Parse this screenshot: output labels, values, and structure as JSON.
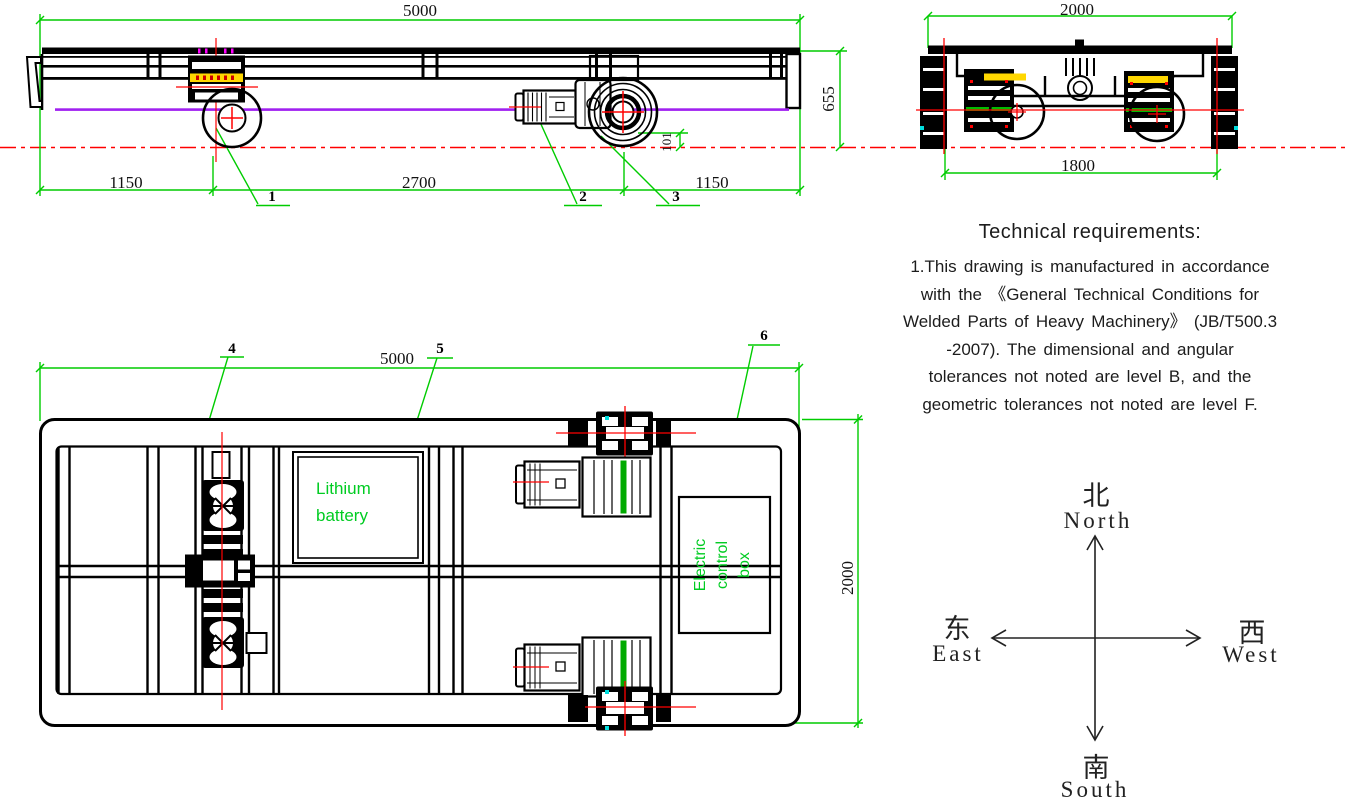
{
  "side_view": {
    "dim_overall_length": "5000",
    "dim_left_overhang": "1150",
    "dim_wheelbase": "2700",
    "dim_right_overhang": "1150",
    "dim_height": "655",
    "dim_flange_height": "101",
    "callouts": [
      "1",
      "2",
      "3"
    ]
  },
  "end_view": {
    "dim_overall_width": "2000",
    "dim_rail_gauge": "1800"
  },
  "plan_view": {
    "dim_length": "5000",
    "dim_width": "2000",
    "callouts": [
      "4",
      "5",
      "6"
    ],
    "battery_label_lines": [
      "Lithium",
      "battery"
    ],
    "control_box_label_lines": [
      "Electric",
      "control",
      "box"
    ]
  },
  "technical_requirements": {
    "title": "Technical requirements:",
    "lines": [
      "1.This drawing is manufactured in accordance",
      "with the 《General Technical Conditions for",
      "Welded Parts of Heavy Machinery》 (JB/T500.3",
      "-2007). The dimensional and angular",
      "tolerances not noted are level B, and the",
      "geometric tolerances not noted are level F."
    ]
  },
  "compass": {
    "north_cn": "北",
    "north_en": "North",
    "south_cn": "南",
    "south_en": "South",
    "east_cn": "东",
    "east_en": "East",
    "west_cn": "西",
    "west_en": "West"
  },
  "colors": {
    "dimension_green": "#00cc00",
    "centerline_red": "#ff0000",
    "rail_purple": "#a020f0",
    "label_green": "#00cc22",
    "highlight_yellow": "#ffd700"
  }
}
